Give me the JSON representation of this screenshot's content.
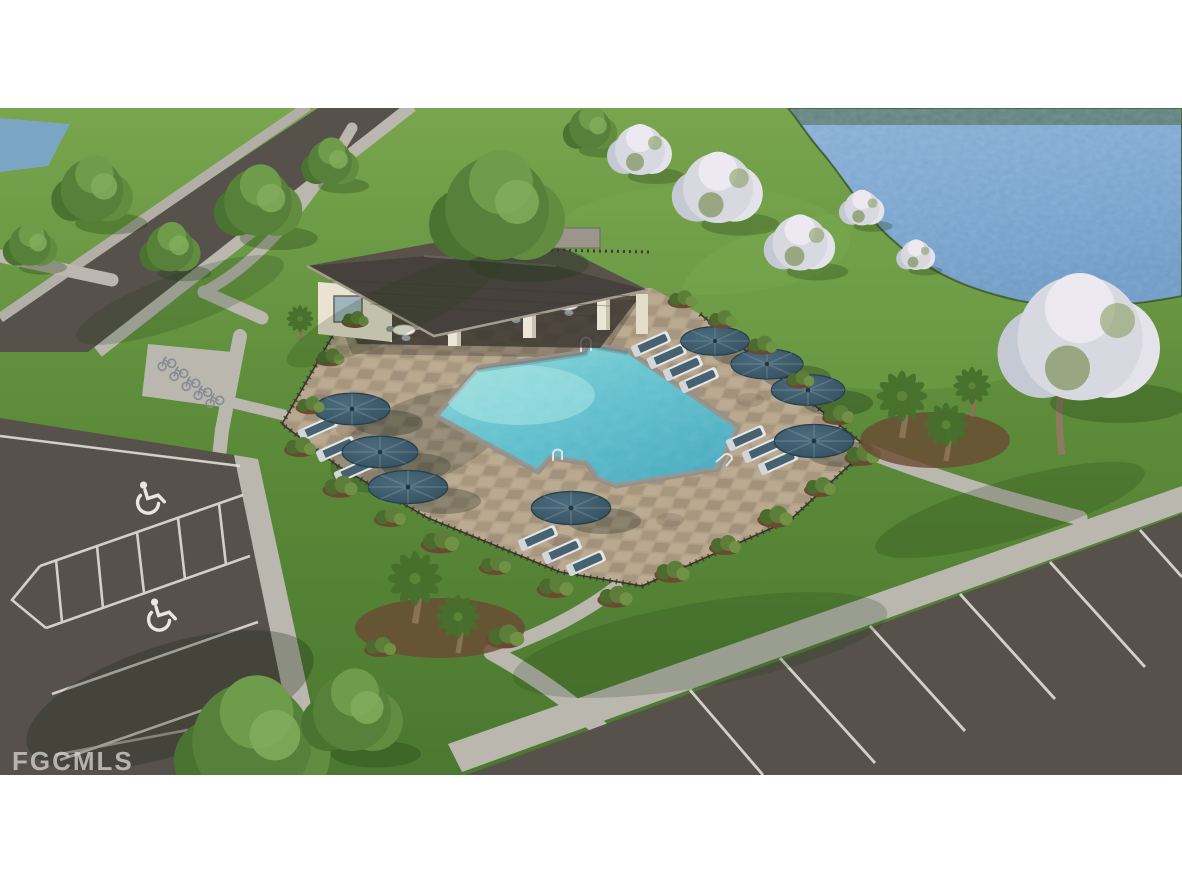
{
  "watermark": {
    "text": "FGCMLS"
  },
  "palette": {
    "sky": "#ffffff",
    "lawn": "#5f8d3a",
    "lawn_light": "#7fae52",
    "lake": "#7ba6d0",
    "water_far_shore": "#44603a",
    "pool_water": "#5cc0cd",
    "pool_coping": "#94908a",
    "deck_paver": "#b3a28a",
    "roof_front": "#46413c",
    "roof_back": "#59524b",
    "building_wall": "#eae3d2",
    "asphalt": "#57514c",
    "concrete": "#bab7af",
    "parking_stripe": "#e9e7e1",
    "umbrella": "#3f5d6e",
    "cushion": "#46616f",
    "shrub": "#4c6b2e",
    "mulch": "#6b4a33",
    "fence": "#38342e",
    "palm_frond": "#46702c",
    "bloom_tree": "#dcdde4",
    "green_tree": "#57813a",
    "watermark_text": "#dedcd9"
  },
  "scene": {
    "objects": [
      "lake",
      "clubhouse-pavilion",
      "swimming-pool",
      "pool-deck",
      "pool-umbrellas",
      "lounge-chairs",
      "patio-tables",
      "pool-fence",
      "accessible-parking-spaces",
      "parking-lot-bottom-left",
      "parking-lot-bottom-right",
      "bike-rack",
      "sidewalk-paths",
      "entry-road",
      "palm-trees",
      "flowering-trees",
      "shade-trees",
      "shrub-beds",
      "lawn"
    ]
  }
}
